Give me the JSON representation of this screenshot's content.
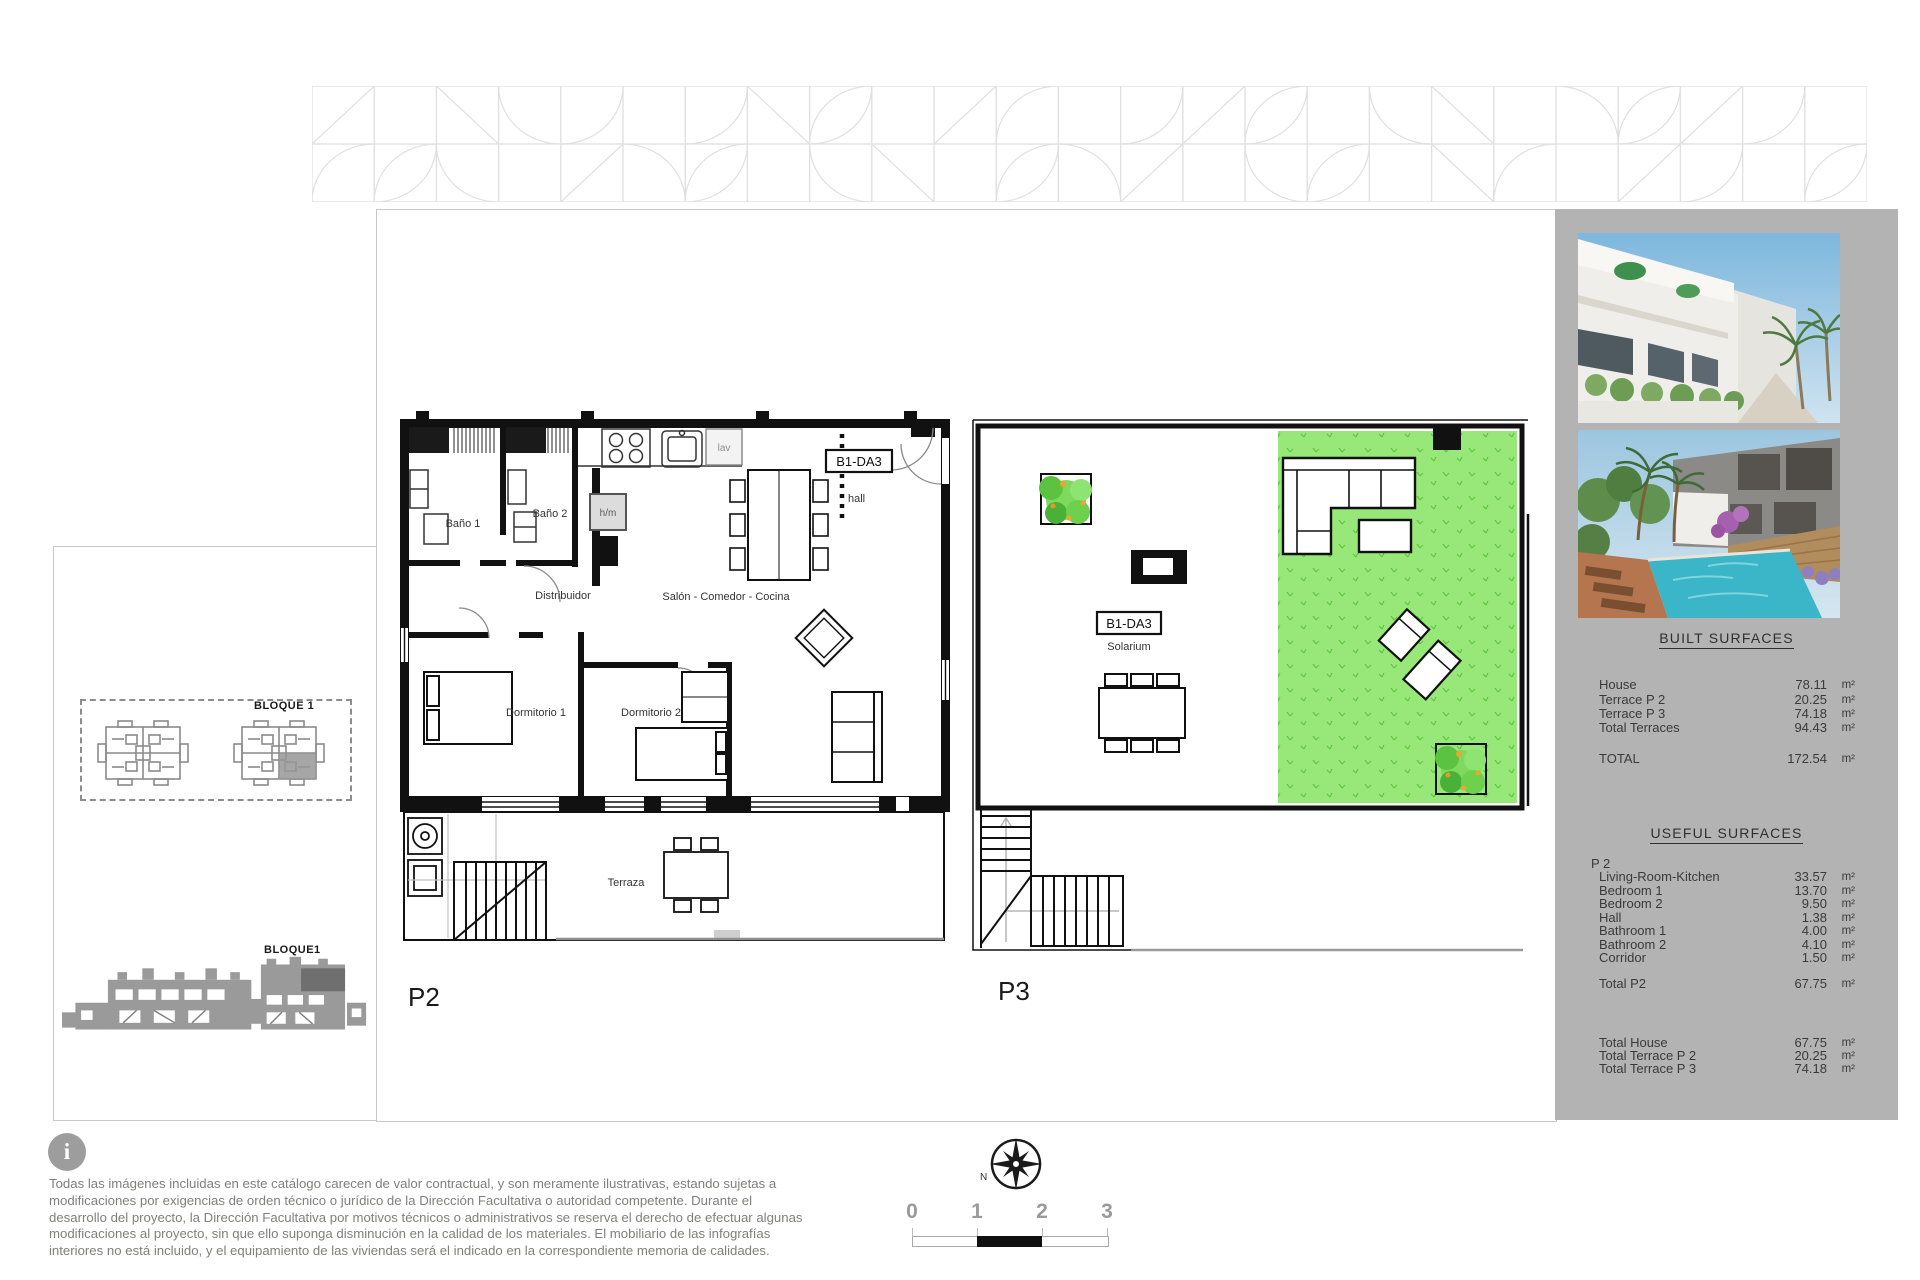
{
  "sidebar": {
    "built": {
      "title": "BUILT SURFACES",
      "rows": [
        {
          "label": "House",
          "value": "78.11",
          "unit": "m²"
        },
        {
          "label": "Terrace P 2",
          "value": "20.25",
          "unit": "m²"
        },
        {
          "label": "Terrace P 3",
          "value": "74.18",
          "unit": "m²"
        },
        {
          "label": "Total Terraces",
          "value": "94.43",
          "unit": "m²"
        }
      ],
      "total": {
        "label": "TOTAL",
        "value": "172.54",
        "unit": "m²"
      }
    },
    "useful": {
      "title": "USEFUL SURFACES",
      "group": "P 2",
      "rows": [
        {
          "label": "Living-Room-Kitchen",
          "value": "33.57",
          "unit": "m²"
        },
        {
          "label": "Bedroom 1",
          "value": "13.70",
          "unit": "m²"
        },
        {
          "label": "Bedroom 2",
          "value": "9.50",
          "unit": "m²"
        },
        {
          "label": "Hall",
          "value": "1.38",
          "unit": "m²"
        },
        {
          "label": "Bathroom 1",
          "value": "4.00",
          "unit": "m²"
        },
        {
          "label": "Bathroom 2",
          "value": "4.10",
          "unit": "m²"
        },
        {
          "label": "Corridor",
          "value": "1.50",
          "unit": "m²"
        }
      ],
      "total": {
        "label": "Total P2",
        "value": "67.75",
        "unit": "m²"
      },
      "summary": [
        {
          "label": "Total House",
          "value": "67.75",
          "unit": "m²"
        },
        {
          "label": "Total Terrace P 2",
          "value": "20.25",
          "unit": "m²"
        },
        {
          "label": "Total Terrace P 3",
          "value": "74.18",
          "unit": "m²"
        }
      ]
    }
  },
  "plans": {
    "p2": {
      "name": "P2",
      "unit_code": "B1-DA3",
      "hall": "hall",
      "bath1": "Baño 1",
      "bath2": "Baño 2",
      "distributor": "Distribuidor",
      "living": "Salón - Comedor - Cocina",
      "bed1": "Dormitorio 1",
      "bed2": "Dormitorio 2",
      "terrace": "Terraza",
      "laundry": "lav",
      "hm": "h/m"
    },
    "p3": {
      "name": "P3",
      "unit_code": "B1-DA3",
      "solarium": "Solarium"
    }
  },
  "site": {
    "block_top": "BLOQUE 1",
    "block_bottom": "BLOQUE1"
  },
  "compass": {
    "north": "N"
  },
  "scale_bar": {
    "ticks": [
      "0",
      "1",
      "2",
      "3"
    ]
  },
  "disclaimer": {
    "icon": "i",
    "text": "Todas las imágenes incluidas en este catálogo carecen de valor contractual, y son meramente ilustrativas, estando sujetas a modificaciones por exigencias de orden técnico o jurídico de la Dirección Facultativa o autoridad competente. Durante el desarrollo del proyecto, la Dirección Facultativa por motivos técnicos o administrativos se reserva el derecho de efectuar algunas modificaciones al proyecto, sin que ello suponga disminución en la calidad de los materiales. El mobiliario de las infografías interiores no está incluido, y el equipamiento de las viviendas será el indicado en la correspondiente memoria de calidades."
  },
  "colors": {
    "panel": "#b3b3b3",
    "lawn": "#97e878",
    "frieze": "#e0e0e0"
  }
}
